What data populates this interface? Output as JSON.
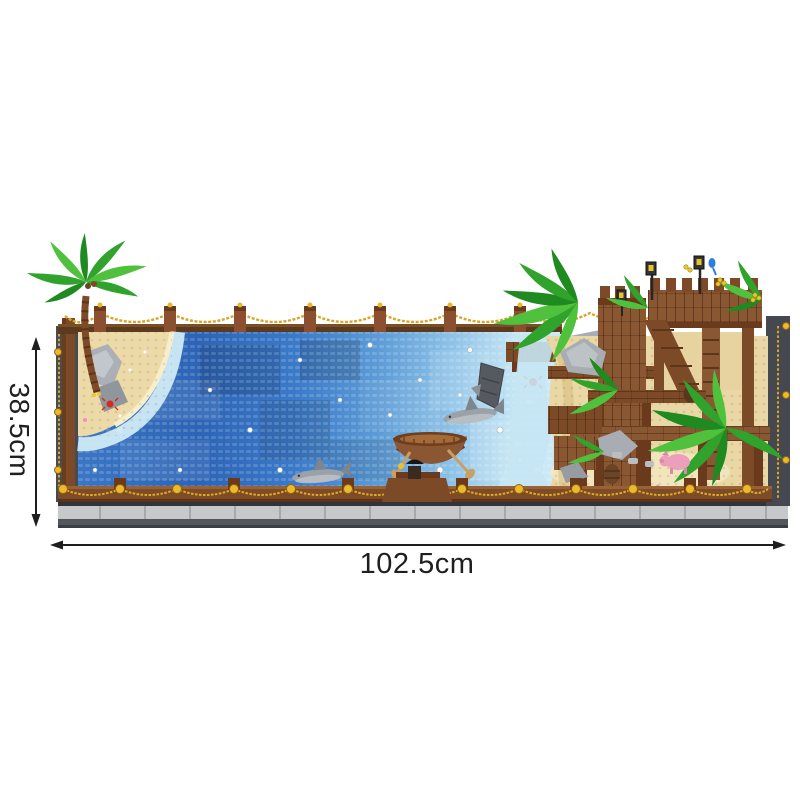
{
  "annotation": {
    "height_label": "38.5cm",
    "width_label": "102.5cm"
  },
  "scene": {
    "type": "brick-built ocean diorama product photo with dimension arrows",
    "elements": [
      "palm-tree",
      "sandy-beach",
      "ocean-mosaic",
      "rope-fence",
      "rowboat",
      "shark",
      "shipwreck",
      "wooden-pier",
      "pirate-dock-fort",
      "tropical-plants",
      "pigs",
      "lanterns",
      "display-base"
    ],
    "palette": {
      "background": "#ffffff",
      "dimension_line": "#1e1e1e",
      "label_text": "#1f1f1f",
      "sea_deep": "#2c63b4",
      "sea_mid": "#3974c2",
      "sea_light": "#7fb5e2",
      "sea_shallow": "#cdeaf6",
      "sand": "#e9d8a6",
      "wood": "#8a5733",
      "wood_dark": "#5d3518",
      "gold_chain": "#d9a626",
      "base_gray": "#3a3d42",
      "tile_gray": "#c7c8ca",
      "frame_gray": "#474b52",
      "leaf_green": "#2fa32b",
      "leaf_light": "#4fc13c",
      "shark_gray": "#99a1a8",
      "pig_pink": "#f2a9c4",
      "crab_red": "#d8281e"
    }
  }
}
